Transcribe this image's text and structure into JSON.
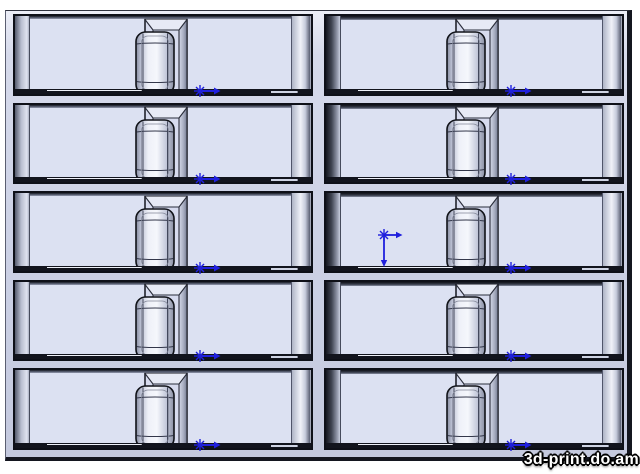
{
  "viewport": {
    "description": "CAD viewport with molded tray of 10 container cavities",
    "background": "#ffffff"
  },
  "watermark": {
    "text": "3d-print.do.am"
  },
  "colors": {
    "viewport_bg": "#ffffff",
    "panel_face": "#ccd1e5",
    "slot_floor": "#dce1f2",
    "edge_dark": "#0e1018",
    "marker_blue": "#2020dd"
  },
  "grid": {
    "rows": 5,
    "cols": 2,
    "cells": [
      {
        "id": "slot-r1c1",
        "row": 1,
        "col": 1,
        "origin": false,
        "point_marker": true
      },
      {
        "id": "slot-r1c2",
        "row": 1,
        "col": 2,
        "origin": false,
        "point_marker": true
      },
      {
        "id": "slot-r2c1",
        "row": 2,
        "col": 1,
        "origin": false,
        "point_marker": true
      },
      {
        "id": "slot-r2c2",
        "row": 2,
        "col": 2,
        "origin": false,
        "point_marker": true
      },
      {
        "id": "slot-r3c1",
        "row": 3,
        "col": 1,
        "origin": false,
        "point_marker": true
      },
      {
        "id": "slot-r3c2",
        "row": 3,
        "col": 2,
        "origin": true,
        "point_marker": true
      },
      {
        "id": "slot-r4c1",
        "row": 4,
        "col": 1,
        "origin": false,
        "point_marker": true
      },
      {
        "id": "slot-r4c2",
        "row": 4,
        "col": 2,
        "origin": false,
        "point_marker": true
      },
      {
        "id": "slot-r5c1",
        "row": 5,
        "col": 1,
        "origin": false,
        "point_marker": true
      },
      {
        "id": "slot-r5c2",
        "row": 5,
        "col": 2,
        "origin": false,
        "point_marker": true
      }
    ]
  }
}
